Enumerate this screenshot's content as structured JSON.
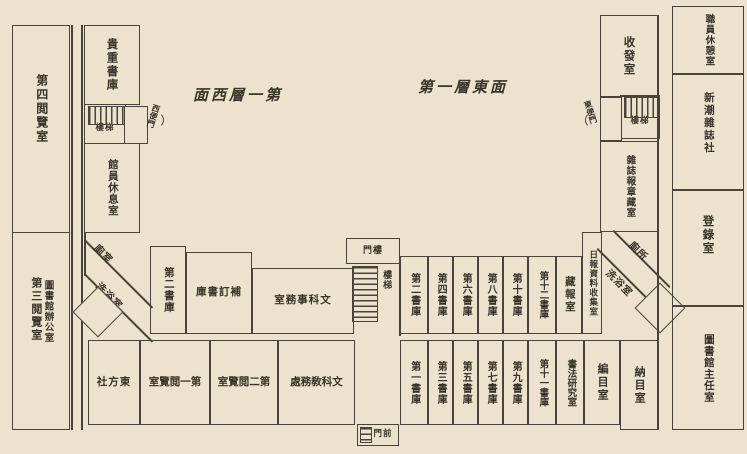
{
  "colors": {
    "paper": "#ece2cd",
    "ink": "#3a332a",
    "wall": "#4a433a"
  },
  "headers": {
    "west": "面西層一第",
    "east": "第一層東面"
  },
  "left_wing": {
    "reading4": "第四閲覽室",
    "reading3": "第三閲覽室",
    "office": "圖書館辦公室",
    "rare_stack": "貴重書庫",
    "stairs": "樓梯",
    "staff_rest": "館員休息室",
    "side_door": "西便門",
    "toilet": "廁室",
    "bath": "洗浴室"
  },
  "middle_upper": {
    "stack2": "第二書庫",
    "binding_stack": "庫書訂補",
    "office": "室務事科文"
  },
  "center": {
    "gate": "門樓",
    "stairs": "樓梯",
    "front_gate": "門前"
  },
  "stacks_upper": [
    "第二書庫",
    "第四書庫",
    "第六書庫",
    "第八書庫",
    "第十書庫",
    "第十二書庫"
  ],
  "stacks_lower": [
    "第一書庫",
    "第三書庫",
    "第五書庫",
    "第七書庫",
    "第九書庫",
    "第十一書庫"
  ],
  "right_wing": {
    "newspaper_store": "藏報室",
    "daily_collect": "日報資料收集室",
    "toilet": "廁所",
    "bath": "洗浴室",
    "dispatch": "收發室",
    "stairs": "樓梯",
    "magazine_store": "雜誌報章藏室",
    "side_door": "東便門",
    "staff_lounge": "職員休憩室",
    "xinchao": "新潮雜誌社",
    "registry": "登錄室",
    "director": "圖書館主任室"
  },
  "bottom_wing": {
    "dongfang": "社方東",
    "reading1": "室覽閲一第",
    "reading2": "室覽閲二第",
    "dean_office": "處務敎科文",
    "calligraphy": "書法研究室",
    "cataloging": "編目室",
    "deposit": "納目室"
  }
}
